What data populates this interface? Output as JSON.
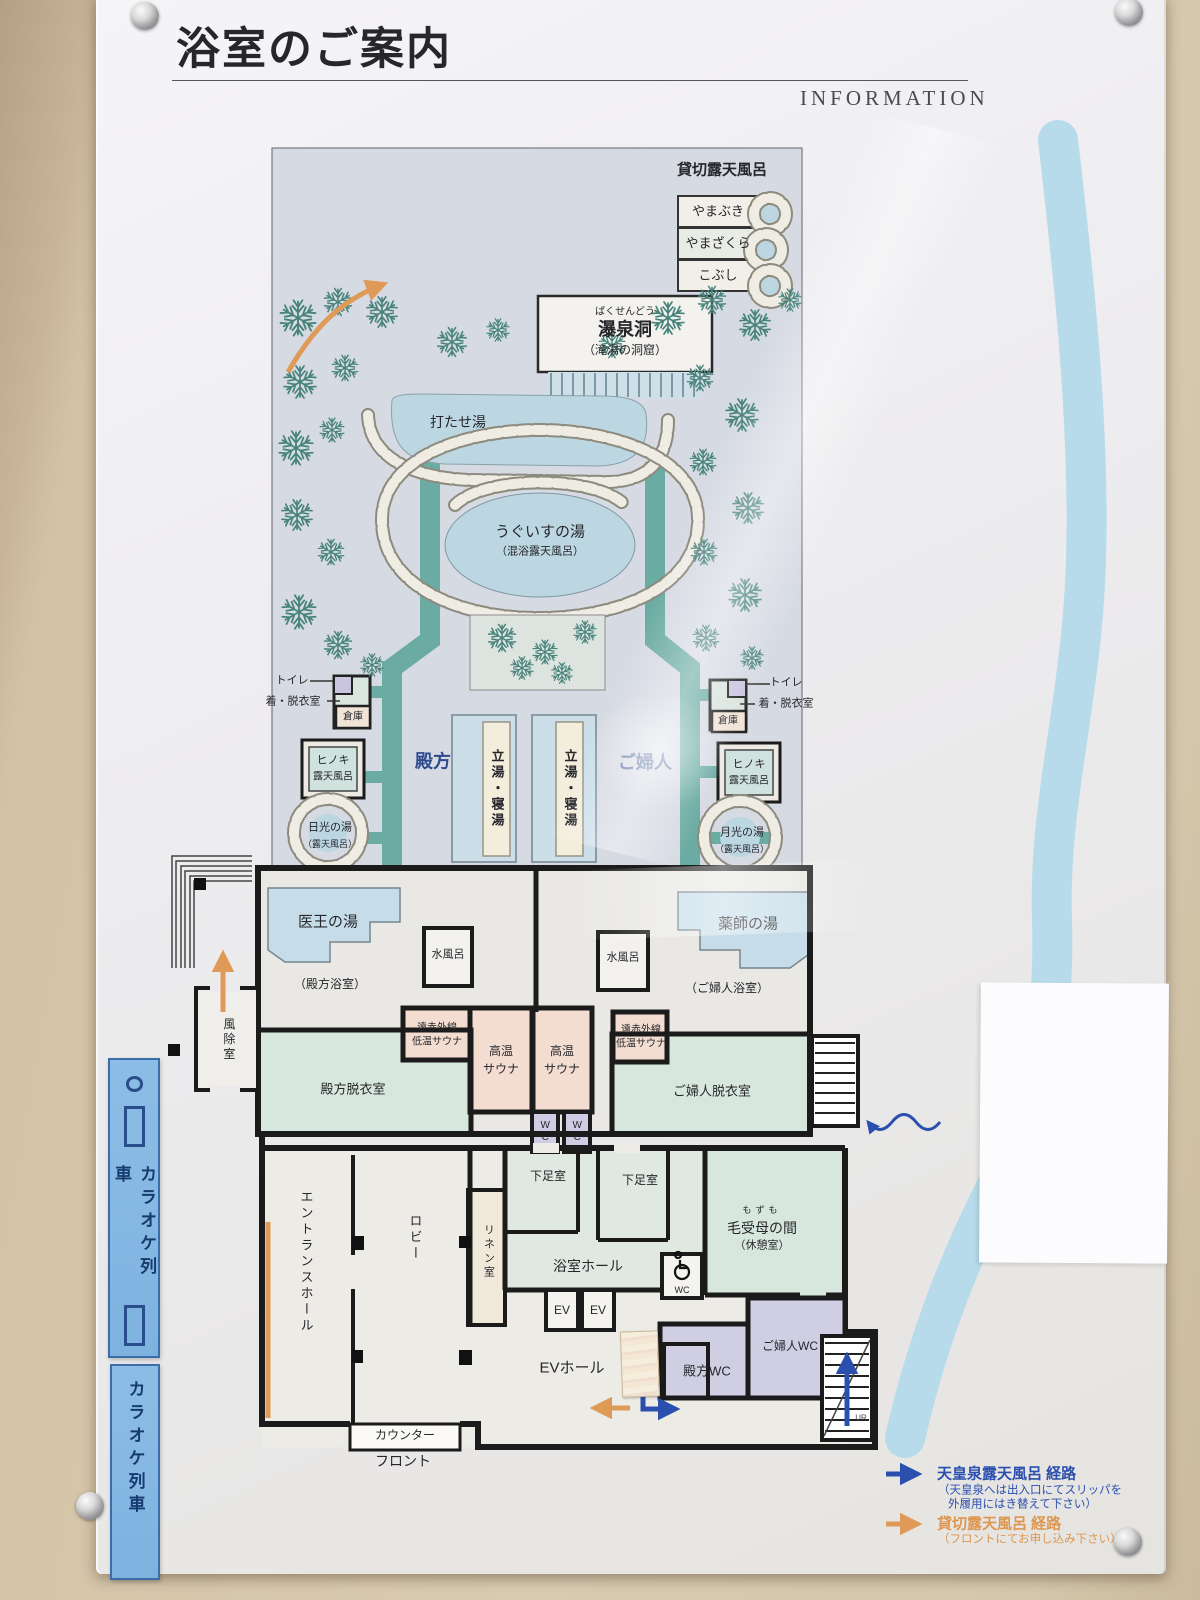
{
  "header": {
    "title": "浴室のご案内",
    "info": "INFORMATION"
  },
  "garden": {
    "kashikiri_title": "貸切露天風呂",
    "kashikiri_rooms": [
      "やまぶき",
      "やまざくら",
      "こぶし"
    ],
    "bakusendo_furigana": "ばくせんどう",
    "bakusendo": "瀑泉洞",
    "bakusendo_note": "（滝湯の洞窟）",
    "utaseyu": "打たせ湯",
    "uguisu": "うぐいすの湯",
    "uguisu_note": "（混浴露天風呂）",
    "toilet": "トイレ",
    "dressing": "着・脱衣室",
    "storage": "倉庫",
    "hinoki_1": "ヒノキ",
    "hinoki_2": "露天風呂",
    "nikko": "日光の湯",
    "gekko": "月光の湯",
    "rotenburo_note": "（露天風呂）",
    "men": "殿方",
    "women": "ご婦人",
    "tachiyu": "立湯・寝湯"
  },
  "floor": {
    "iou": "医王の湯",
    "yakushi": "薬師の湯",
    "mizuburo": "水風呂",
    "men_bath_note": "（殿方浴室）",
    "women_bath_note": "（ご婦人浴室）",
    "far_sauna_1": "遠赤外線",
    "far_sauna_2": "低温サウナ",
    "hot_sauna_1": "高温",
    "hot_sauna_2": "サウナ",
    "men_dressing": "殿方脱衣室",
    "women_dressing": "ご婦人脱衣室",
    "wc": "WC",
    "gesoku": "下足室",
    "fujo": "風除室",
    "entrance": "エントランスホール",
    "lobby": "ロビー",
    "linen": "リネン室",
    "bath_hall": "浴室ホール",
    "mozumo_furigana": "もずも",
    "mozumo": "毛受母の間",
    "mozumo_note": "（休憩室）",
    "ev": "EV",
    "ev_hall": "EVホール",
    "men_wc": "殿方WC",
    "women_wc": "ご婦人WC",
    "counter": "カウンター",
    "front": "フロント",
    "stairs_mark": "UR"
  },
  "legend": {
    "blue_label": "天皇泉露天風呂 経路",
    "blue_note_1": "（天皇泉へは出入口にてスリッパを",
    "blue_note_2": "外履用にはき替えて下さい）",
    "orange_label": "貸切露天風呂 経路",
    "orange_note": "（フロントにてお申し込み下さい）"
  },
  "banner": {
    "karaoke": "カラオケ列車"
  },
  "colors": {
    "route_blue": "#2b4fae",
    "route_orange": "#e0995c",
    "path_teal": "#6aaba3",
    "water": "#bcd7e2",
    "banner_blue": "#82b7e2"
  }
}
